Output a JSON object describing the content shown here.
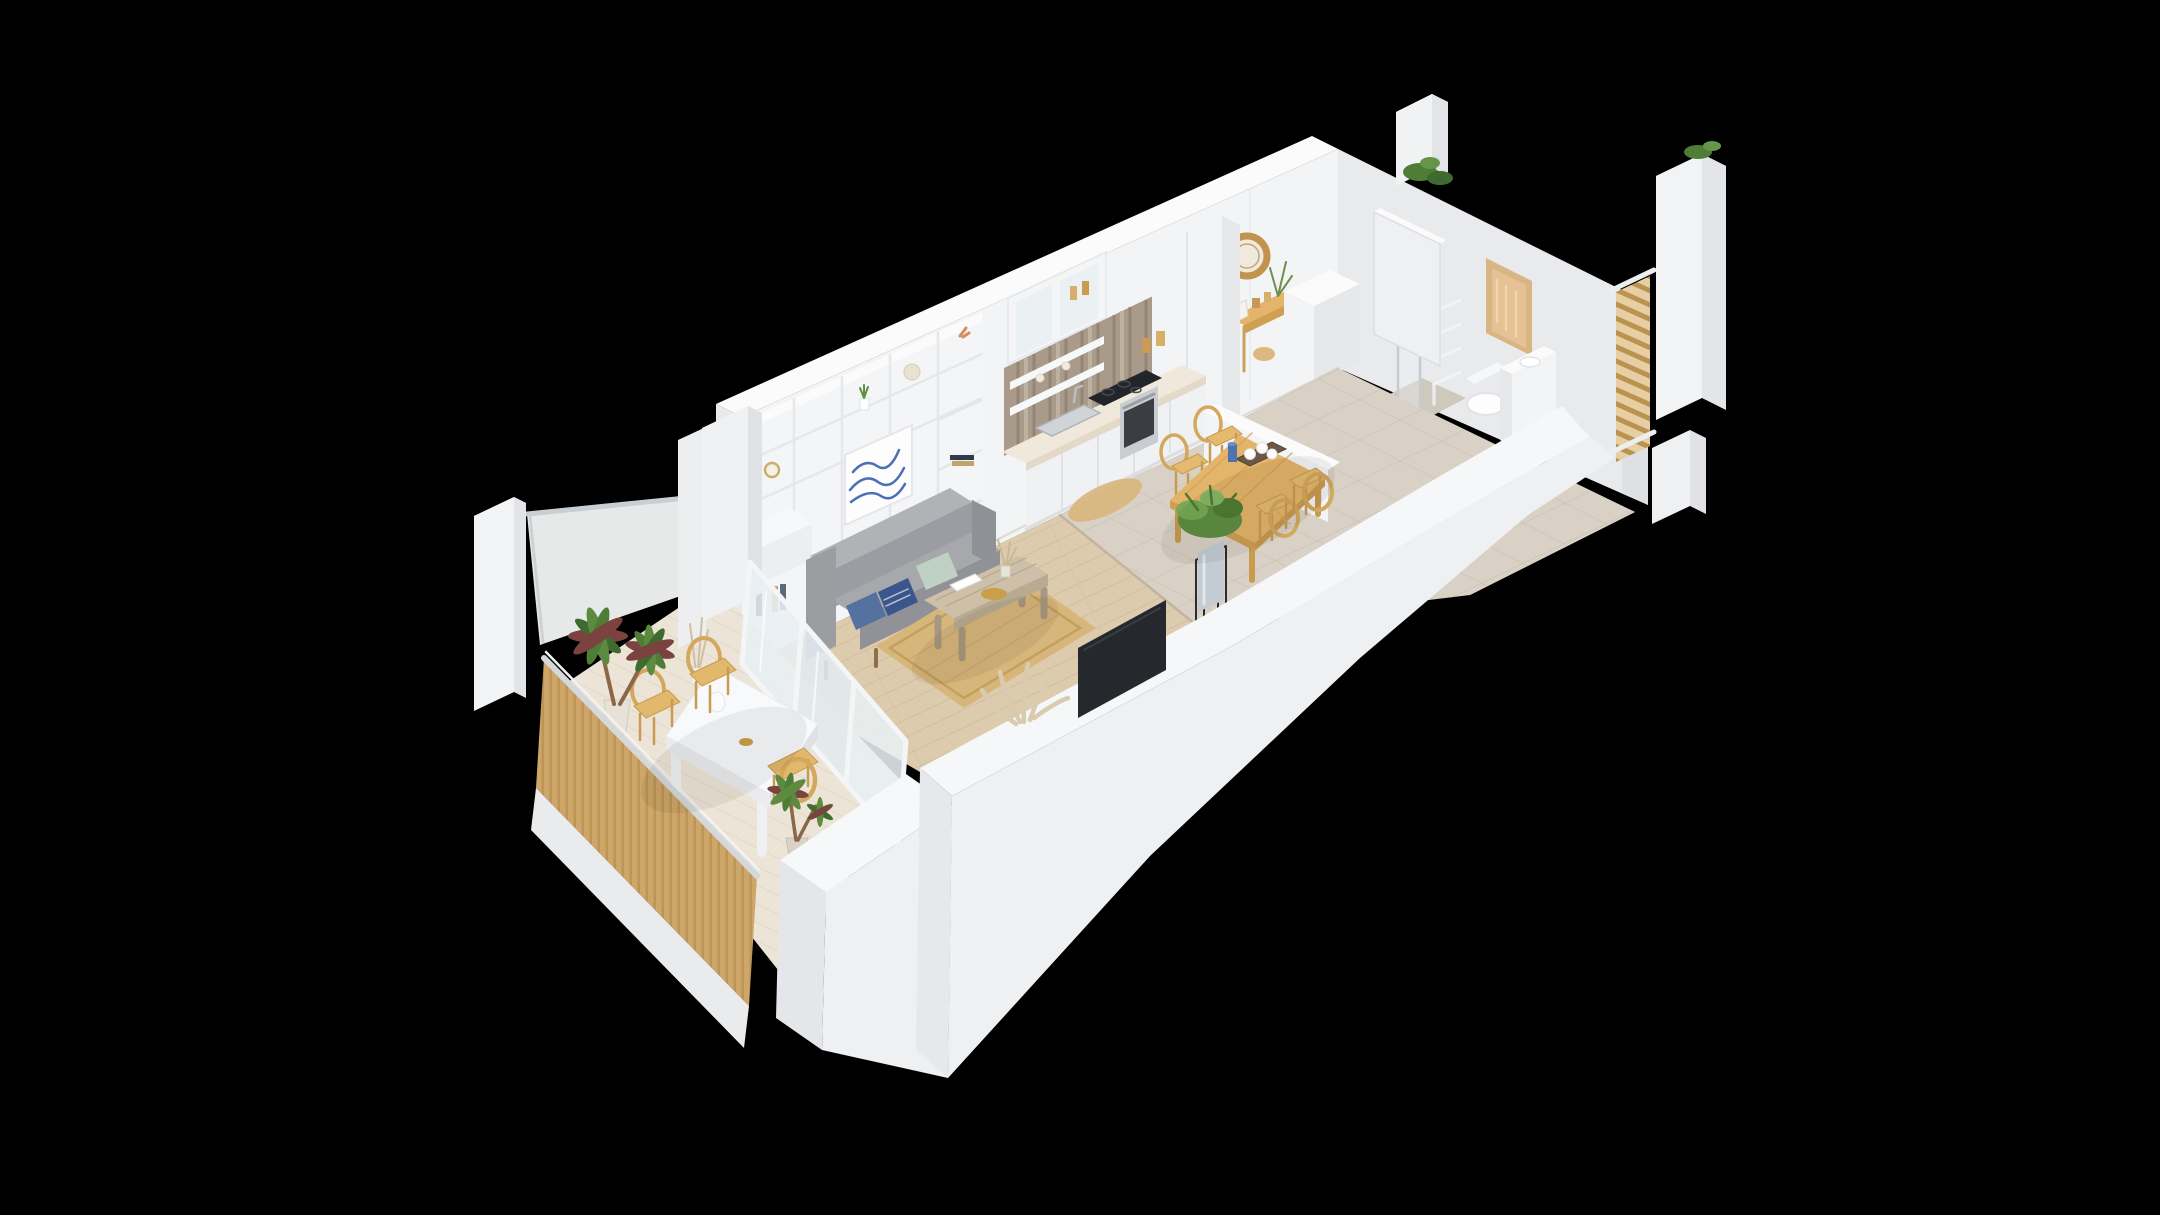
{
  "scene": {
    "type": "isometric-3d-floor-plan-render",
    "subject": "studio-apartment-with-balcony",
    "background": "black",
    "rooms": [
      {
        "name": "living-room",
        "items": [
          "built-in-shelf-wall",
          "wave-art-print",
          "gray-sofa",
          "blue-pillows",
          "sage-pillow",
          "coffee-table",
          "jute-rug",
          "driftwood-decor",
          "tv-panel",
          "desk-return"
        ]
      },
      {
        "name": "kitchen",
        "items": [
          "wood-plank-backsplash",
          "glass-upper-cabinet",
          "open-shelves",
          "tall-cabinet",
          "countertop",
          "induction-cooktop",
          "stainless-sink",
          "oven",
          "base-cabinets",
          "jars",
          "oval-jute-mat"
        ]
      },
      {
        "name": "dining-area",
        "items": [
          "wood-dining-table",
          "rattan-chair",
          "rattan-chair",
          "rattan-chair",
          "rattan-chair",
          "serving-tray-with-cups",
          "blue-bottle",
          "potted-plant-on-stand"
        ]
      },
      {
        "name": "hallway",
        "items": [
          "console-table",
          "round-rattan-mirror",
          "vase-with-branches",
          "white-closet",
          "open-white-door",
          "black-floor-ornament"
        ]
      },
      {
        "name": "bathroom",
        "items": [
          "frosted-amber-window",
          "towel-ladder",
          "toilet",
          "vanity-basin",
          "shower-glass-panels",
          "shower-tile-floor"
        ]
      },
      {
        "name": "balcony",
        "items": [
          "frosted-glass-screen",
          "wood-slat-railing",
          "white-outdoor-table",
          "rattan-chair",
          "rattan-chair",
          "rattan-chair",
          "palm-plant",
          "small-palm-plant",
          "vase-and-jug"
        ]
      }
    ],
    "structure": [
      "cutaway-white-walls",
      "corner-pillar-west",
      "corner-pillar-northwest",
      "pillar-north",
      "pillar-east",
      "juliet-wood-railing",
      "green-plants-on-wall-tops"
    ]
  },
  "palette": {
    "background": "#000000",
    "wall_top": "#fbfbfc",
    "wall_light": "#f3f4f5",
    "wall_mid": "#e9eaec",
    "wall_shade": "#dfe0e3",
    "wall_front": "#eff0f2",
    "floor_wood": "#ddcbae",
    "floor_tile": "#d9d1c5",
    "balcony_floor": "#ece4d6",
    "backsplash_wood": "#a99a89",
    "counter": "#f0e9db",
    "slat_wood": "#cfa76a",
    "rattan": "#d3a75c",
    "table_wood": "#e3b469",
    "rug_jute": "#d7b67c",
    "sofa_gray": "#a6a8ac",
    "pillow_blue": "#54719f",
    "pillow_navy": "#3b568c",
    "pillow_sage": "#bfd1c2",
    "art_blue": "#4a6fb5",
    "plant_green": "#5f8f41",
    "palm_dark": "#3f6b31",
    "palm_maroon": "#7b4240",
    "tv_black": "#25282c",
    "window_amber": "#e6c194",
    "window_frame": "#d8b684",
    "steel": "#cfd4d7",
    "glass_frost": "#f3f5f5",
    "black_accent": "#1a1b1d"
  }
}
